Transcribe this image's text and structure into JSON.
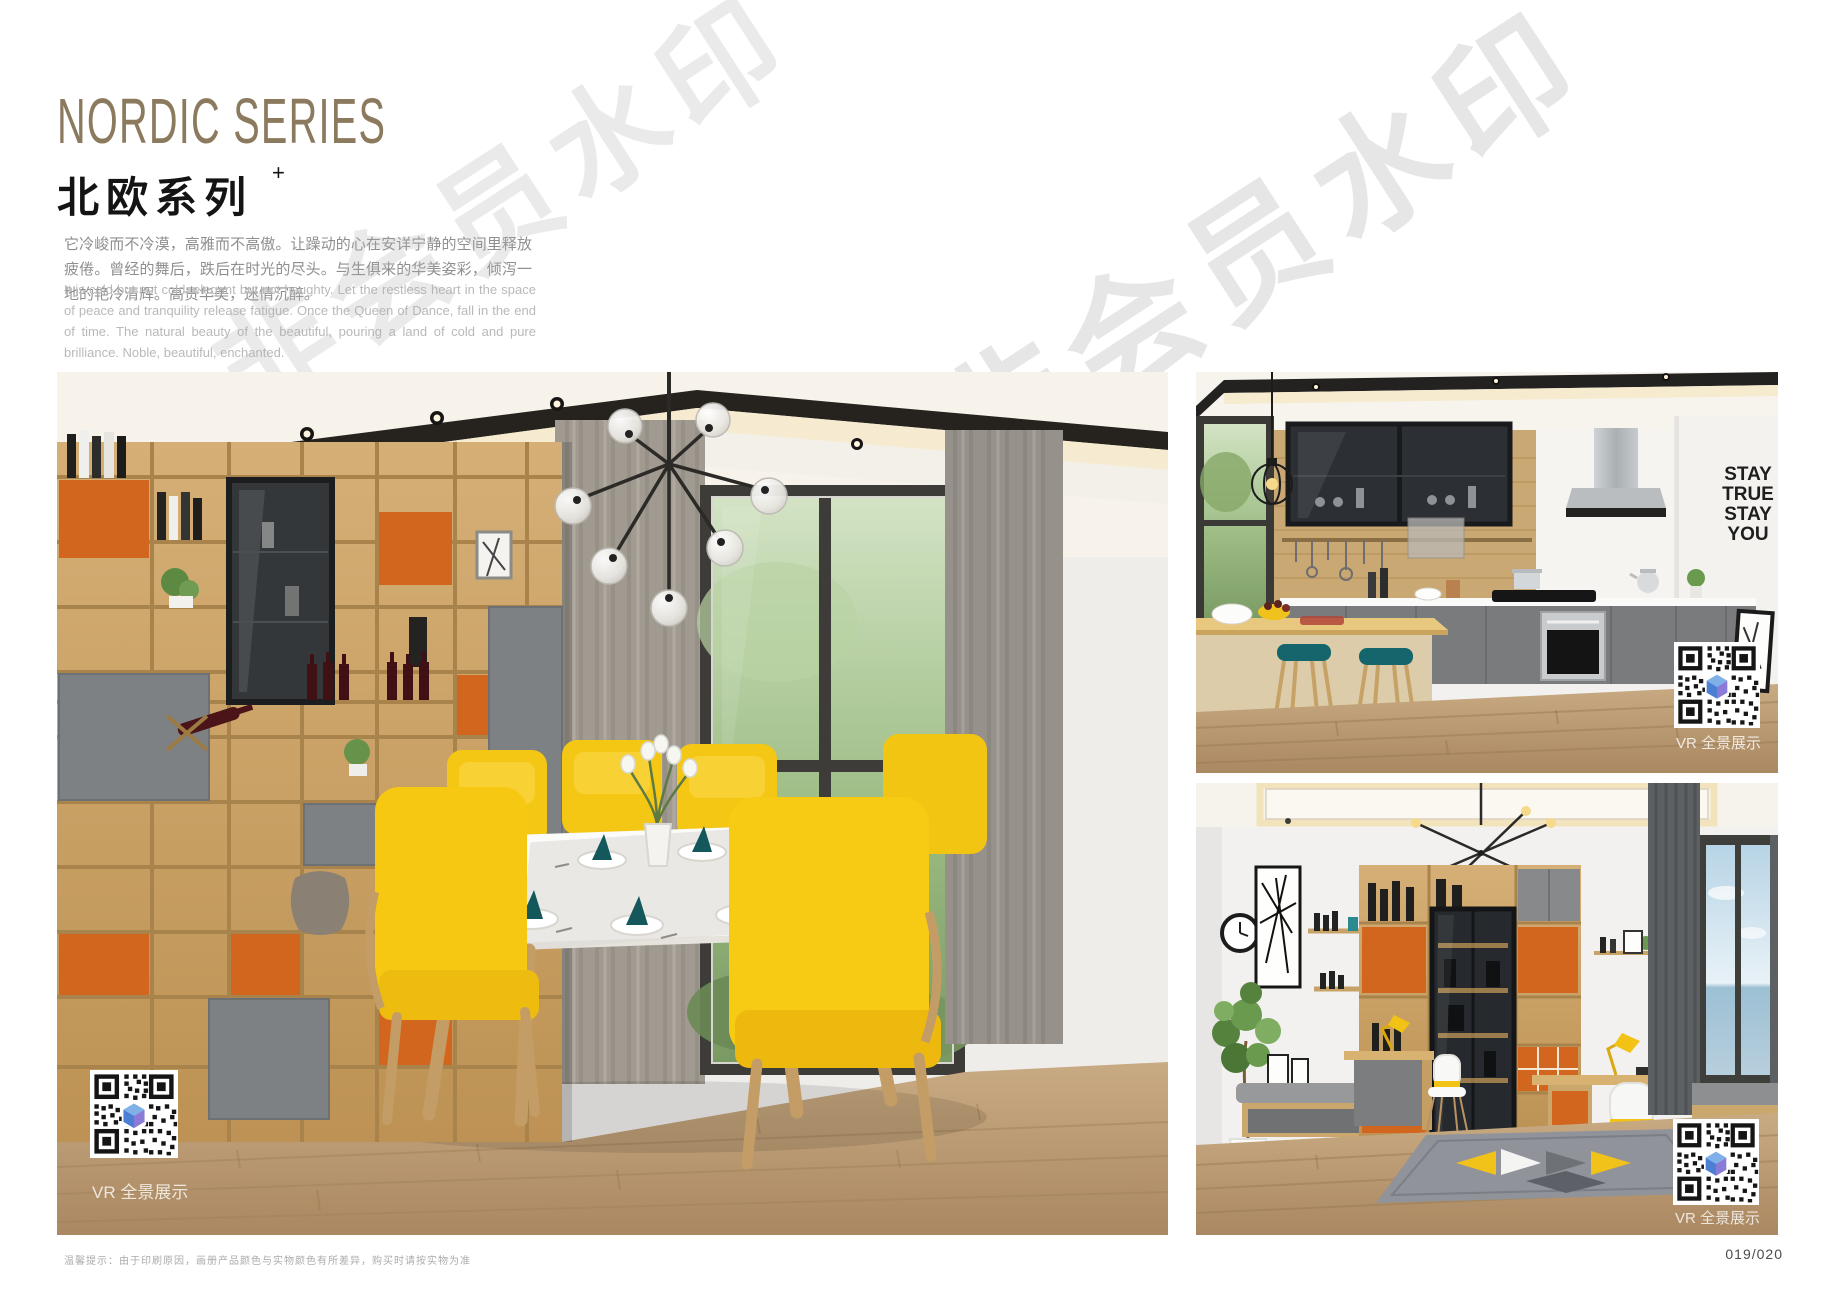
{
  "header": {
    "title_en": "NORDIC SERIES",
    "title_cn": "北欧系列",
    "title_suffix": "+",
    "intro_cn": "它冷峻而不冷漠，高雅而不高傲。让躁动的心在安详宁静的空间里释放疲倦。曾经的舞后，跌后在时光的尽头。与生俱来的华美姿彩，倾泻一地的艳冷清辉。高贵华美，迷情沉醉。",
    "intro_en": "It is cold but not cold, elegant but not haughty. Let the restless heart in the space of peace and tranquility release fatigue. Once the Queen of Dance, fall in the end of time. The natural beauty of the beautiful, pouring a land of cold and pure brilliance. Noble, beautiful, enchanted."
  },
  "watermark": {
    "text": "非会员水印"
  },
  "photos": {
    "dining": {
      "caption": "VR 全景展示"
    },
    "kitchen": {
      "caption": "VR 全景展示",
      "wall_decal": [
        "STAY",
        "TRUE",
        "STAY",
        "YOU"
      ]
    },
    "study": {
      "caption": "VR 全景展示"
    }
  },
  "footer": {
    "note": "温馨提示：由于印刷原因，画册产品颜色与实物颜色有所差异，购买时请按实物为准",
    "page_number": "019/020"
  },
  "colors": {
    "title_bronze": "#8c7a5e",
    "wood": "#c9a267",
    "orange_accent": "#d2661e",
    "cabinet_gray": "#7d7f81",
    "chair_yellow": "#f5c714",
    "teal": "#1c6f74",
    "qr_logo_blue": "#4a7fd4"
  }
}
